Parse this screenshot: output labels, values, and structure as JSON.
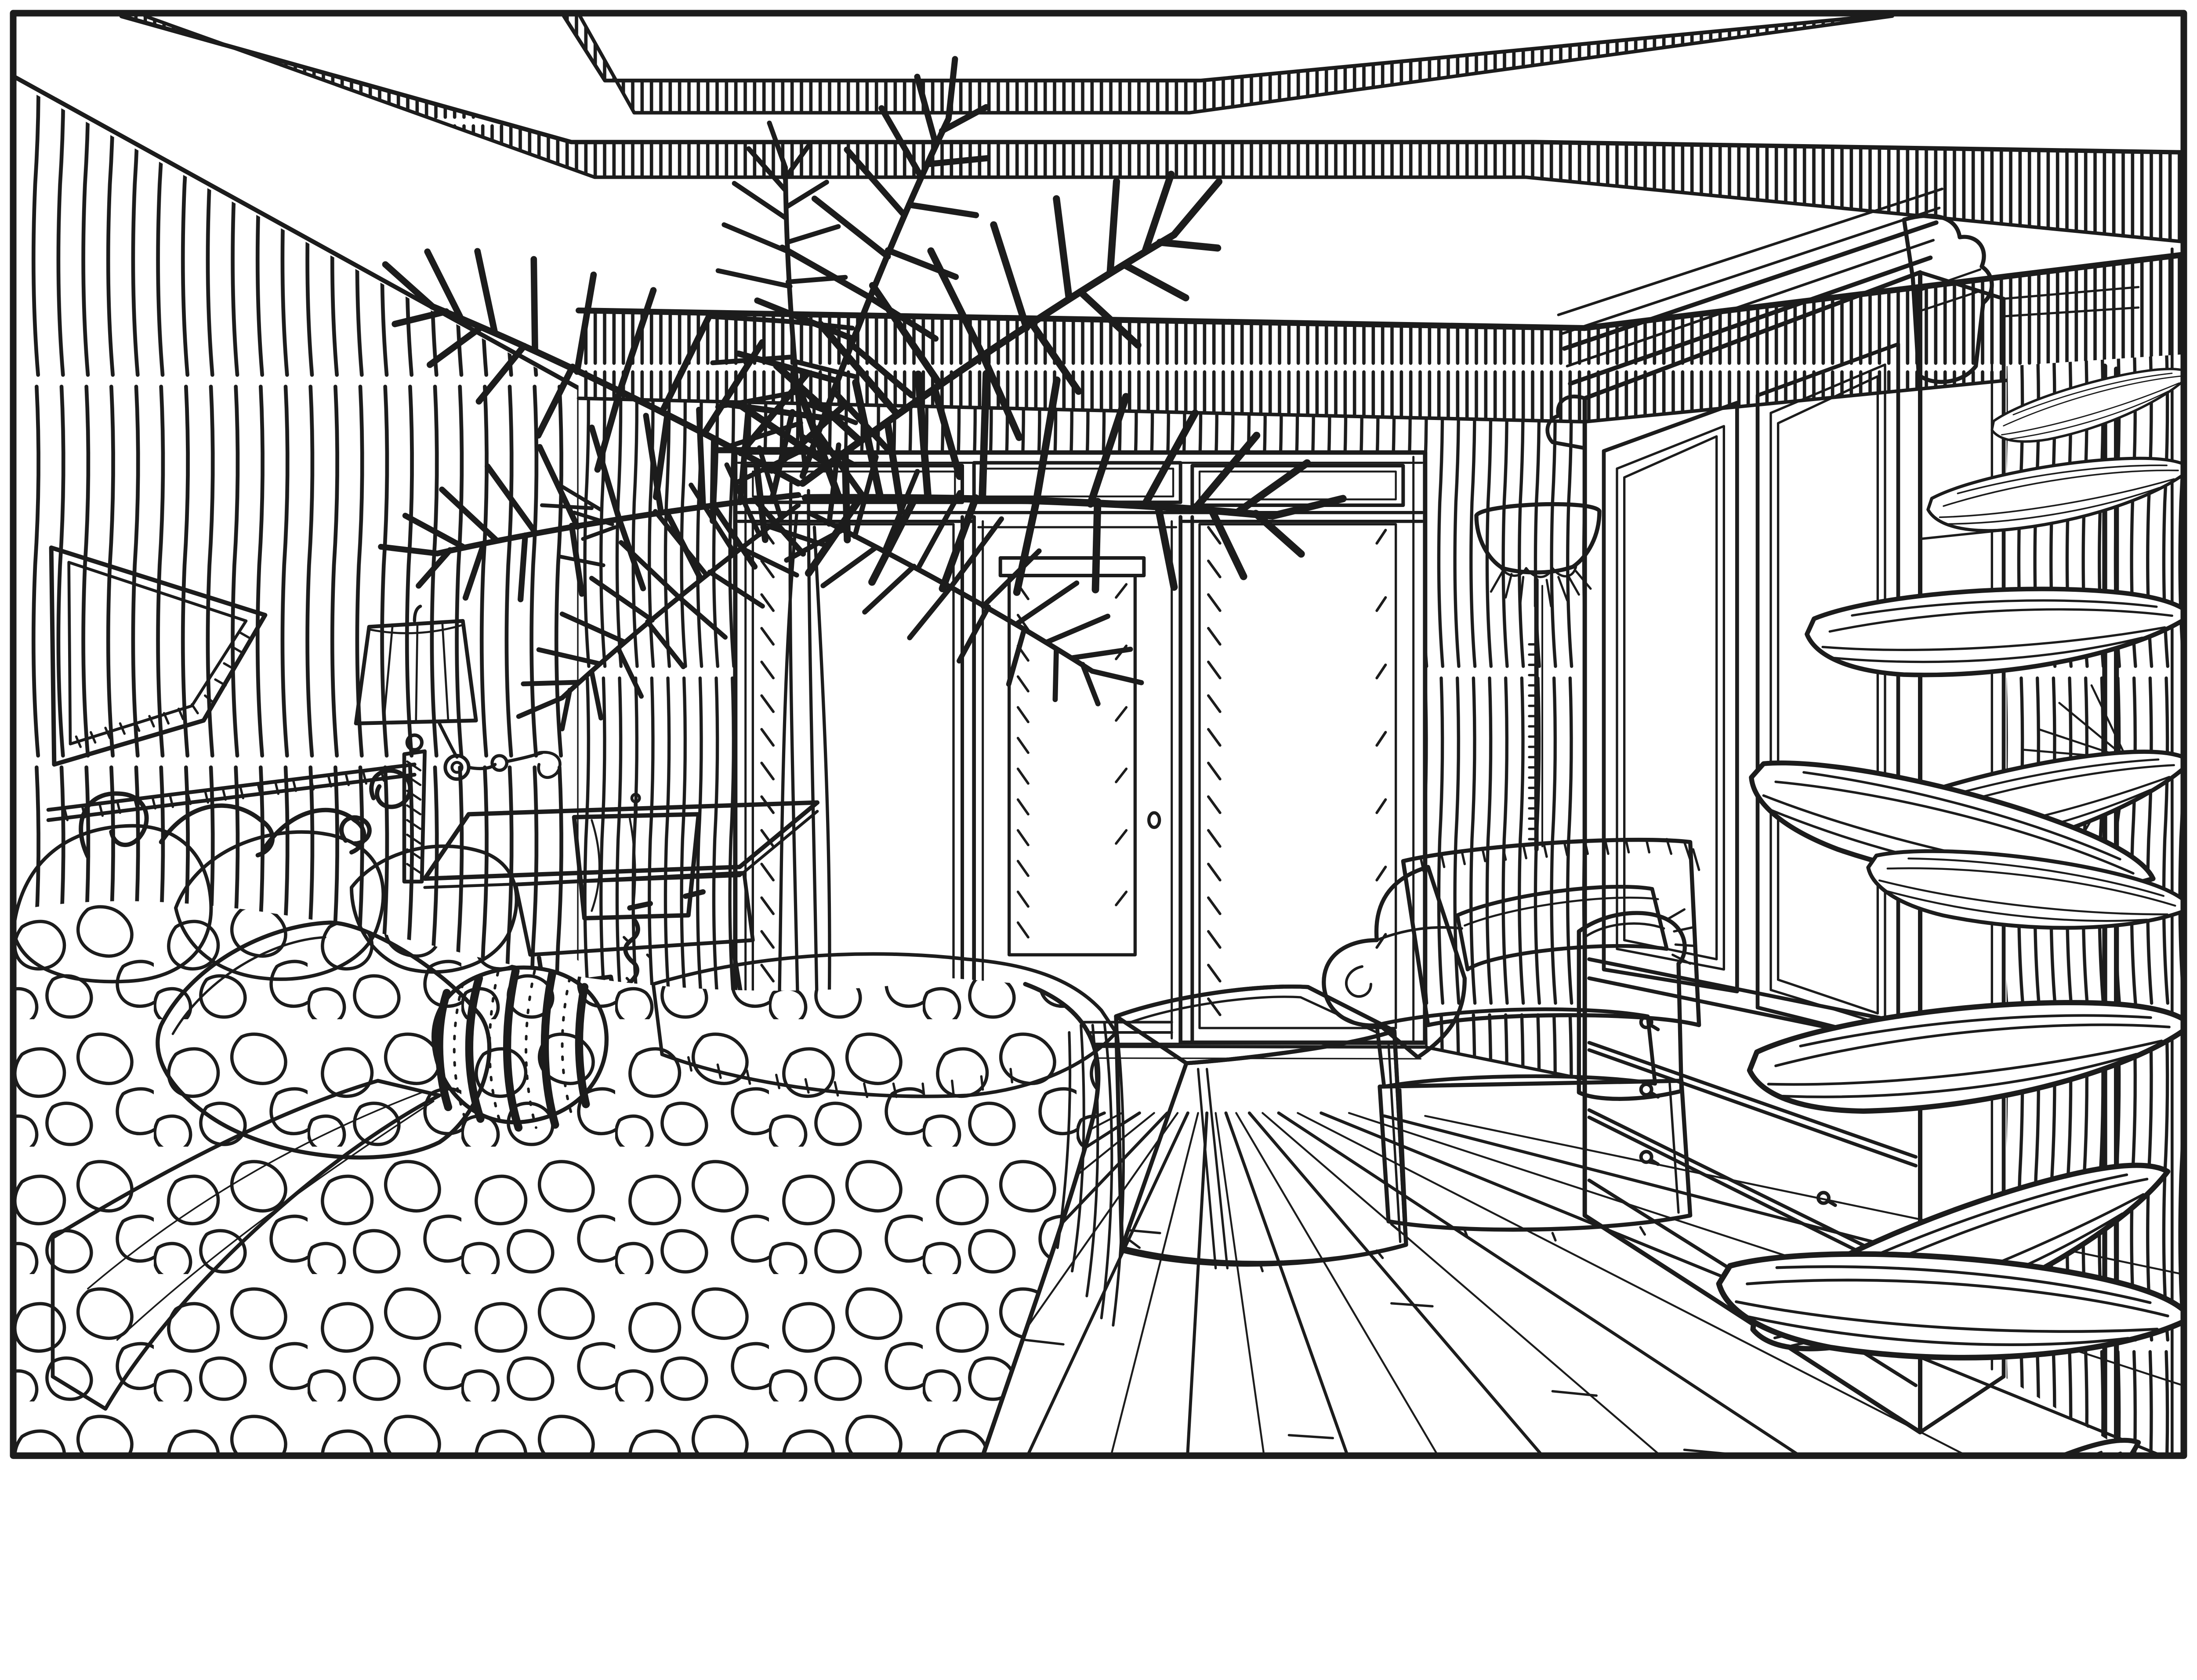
{
  "artwork": {
    "title": "Bedroom interior — pen-and-ink one-point perspective sketch",
    "type": "line drawing",
    "medium": "black ink on white paper",
    "subject": "master bedroom with tray ceiling, shuttered french doors, bed, armoire, armchair with ottoman and palms"
  },
  "palette": {
    "ink": "#1c1c1c",
    "paper": "#ffffff"
  },
  "scene": {
    "labels": {
      "canvas": "hand-drawn bedroom perspective sketch",
      "border": "rectangular ink border of the drawing",
      "ceiling": "double tray ceiling with hatched fascia bands",
      "inner_tray": "deep recessed ceiling panel band",
      "outer_tray": "outer tray ceiling band",
      "back_frieze": "hatched crown frieze over back wall",
      "right_frieze": "hatched crown frieze over right wall",
      "left_wall": "striped wallpaper left wall",
      "back_wall": "striped wallpaper back wall",
      "right_wall": "striped wallpaper right wall sliver",
      "mirror": "framed mirror on left wall",
      "sconce": "wall lamp with pleated shade over headboard",
      "headboard": "wrought-iron scrolled headboard",
      "bed": "bed with pebble-patterned comforter",
      "pillows": "pile of patterned pillows",
      "lumbar_pillow": "speckled lumbar pillow",
      "bolster": "striped barrel bolster pillow",
      "sheet": "white folded sheet band",
      "throw": "cross-hatched throw blanket with fringe",
      "nightstand": "night table with drawer",
      "table_lamp": "small table lamp with square shade",
      "photo_frame": "small picture frame on night table",
      "palm_plant": "tall areca palm behind the bed",
      "door_unit": "french door wall with louvered shutters",
      "transom": "transom panels above the doors",
      "left_shutter": "left louvered shutter panel",
      "right_shutter": "right louvered shutter panel",
      "door": "french door with louver insert",
      "door_knob": "door knob",
      "torchiere": "torchiere floor lamp with bowl shade",
      "armoire": "large paneled armoire with drawers",
      "armoire_doors": "two raised-panel armoire doors",
      "armoire_drawers": "three armoire drawers with ring pulls",
      "armchair": "slip-covered armchair with fringe",
      "ottoman": "skirted ottoman",
      "floor": "wood plank floor in perspective",
      "right_palm": "large palm fronds in right foreground"
    },
    "counts": {
      "transom_panels": 3,
      "shutter_panels": 2,
      "armoire_doors": 2,
      "armoire_drawers": 3,
      "drawer_pulls": 6,
      "lamps": 3,
      "plants": 2
    }
  }
}
